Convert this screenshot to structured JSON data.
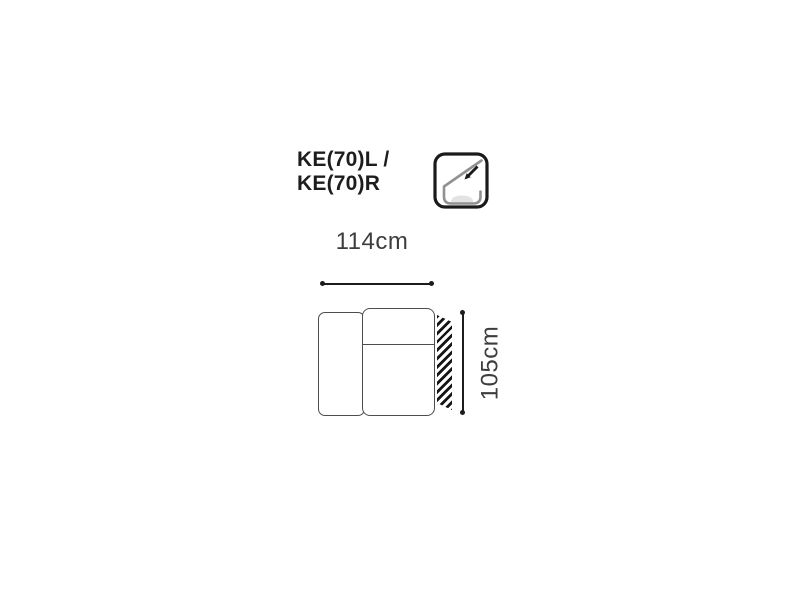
{
  "diagram": {
    "title_line1": "KE(70)L /",
    "title_line2": "KE(70)R",
    "width_label": "114cm",
    "height_label": "105cm",
    "feature_icon": "recline-backrest-icon"
  },
  "colors": {
    "background": "#ffffff",
    "title_text": "#1d1d1d",
    "dimension_text": "#3d3d3d",
    "outline_stroke": "#4d4d4d",
    "dimension_line": "#1c1c1c",
    "hatch": "#161616",
    "icon_border": "#1a1a1a",
    "icon_gray_stroke": "#919191",
    "icon_cushion_fill": "#e3e3e3"
  }
}
